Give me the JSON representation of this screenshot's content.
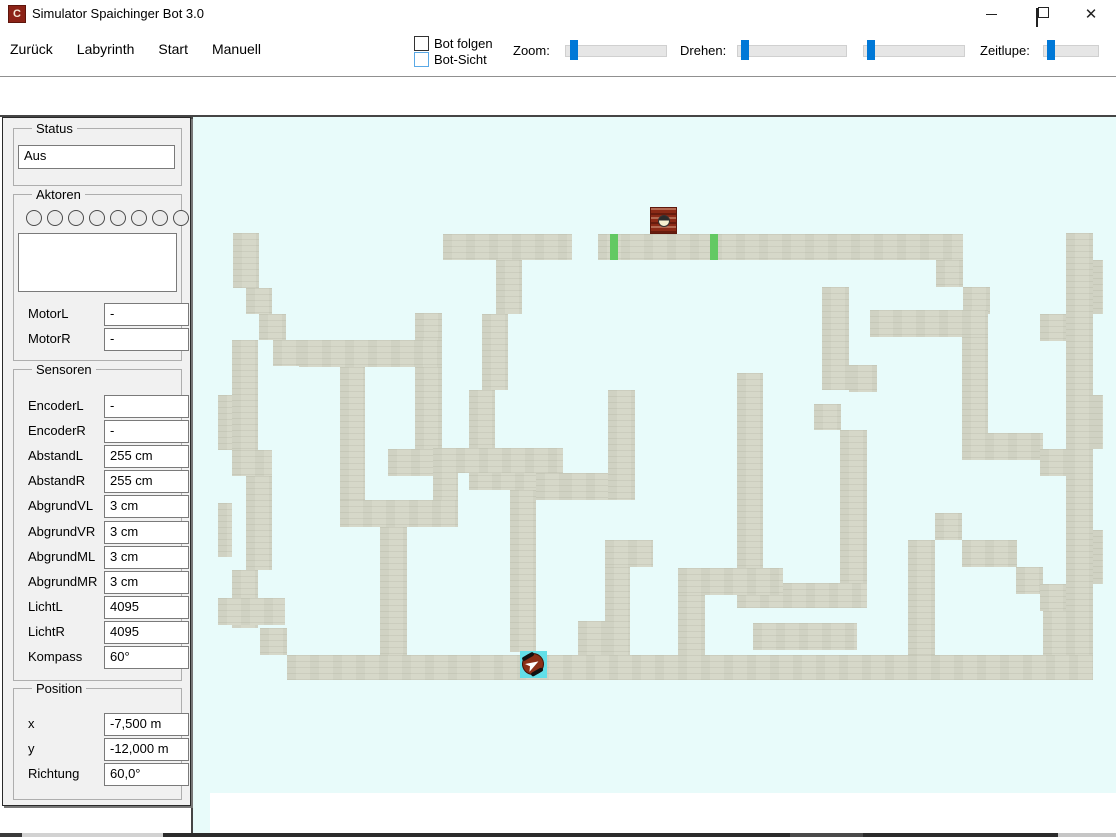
{
  "window": {
    "title": "Simulator Spaichinger Bot 3.0",
    "icon_letter": "C",
    "controls": [
      "minimize",
      "restore",
      "close"
    ]
  },
  "menu": {
    "items": [
      "Zurück",
      "Labyrinth",
      "Start",
      "Manuell"
    ]
  },
  "toolbar": {
    "checkboxes": [
      {
        "label": "Bot folgen",
        "checked": false,
        "style": "dark"
      },
      {
        "label": "Bot-Sicht",
        "checked": false,
        "style": "blue"
      }
    ],
    "sliders": [
      {
        "label": "Zoom:",
        "label_x": 513,
        "track_x": 565,
        "track_w": 100,
        "thumb_x": 4
      },
      {
        "label": "Drehen:",
        "label_x": 680,
        "track_x": 737,
        "track_w": 108,
        "thumb_x": 3
      },
      {
        "label": "",
        "label_x": 855,
        "track_x": 863,
        "track_w": 100,
        "thumb_x": 3
      },
      {
        "label": "Zeitlupe:",
        "label_x": 980,
        "track_x": 1043,
        "track_w": 54,
        "thumb_x": 3
      }
    ],
    "accent_color": "#0078d7"
  },
  "panel": {
    "status": {
      "title": "Status",
      "value": "Aus"
    },
    "aktoren": {
      "title": "Aktoren",
      "led_count": 8,
      "textbox_value": "",
      "rows": [
        {
          "label": "MotorL",
          "value": "-"
        },
        {
          "label": "MotorR",
          "value": "-"
        }
      ]
    },
    "sensoren": {
      "title": "Sensoren",
      "rows": [
        {
          "label": "EncoderL",
          "value": "-"
        },
        {
          "label": "EncoderR",
          "value": "-"
        },
        {
          "label": "AbstandL",
          "value": "255 cm"
        },
        {
          "label": "AbstandR",
          "value": "255 cm"
        },
        {
          "label": "AbgrundVL",
          "value": "3 cm"
        },
        {
          "label": "AbgrundVR",
          "value": "3 cm"
        },
        {
          "label": "AbgrundML",
          "value": "3 cm"
        },
        {
          "label": "AbgrundMR",
          "value": "3 cm"
        },
        {
          "label": "LichtL",
          "value": "4095"
        },
        {
          "label": "LichtR",
          "value": "4095"
        },
        {
          "label": "Kompass",
          "value": "60°"
        }
      ]
    },
    "position": {
      "title": "Position",
      "rows": [
        {
          "label": "x",
          "value": "-7,500 m"
        },
        {
          "label": "y",
          "value": "-12,000 m"
        },
        {
          "label": "Richtung",
          "value": "60,0°"
        }
      ]
    }
  },
  "maze": {
    "background_color": "#e8fbfa",
    "wall_color": "#d6d8c9",
    "marker_color": "#63c963",
    "bot_square_color": "#63dfe8",
    "bot_body_color": "#8a2f17",
    "red_block": {
      "x": 650,
      "y": 207,
      "w": 27,
      "h": 27
    },
    "green_markers": [
      {
        "x": 610,
        "y": 234,
        "w": 8,
        "h": 26
      },
      {
        "x": 710,
        "y": 234,
        "w": 8,
        "h": 26
      }
    ],
    "bot": {
      "x": 520,
      "y": 651,
      "w": 27,
      "h": 27,
      "heading_deg": 60
    },
    "walls": [
      [
        233,
        233,
        26,
        55
      ],
      [
        246,
        288,
        26,
        26
      ],
      [
        259,
        314,
        27,
        26
      ],
      [
        273,
        340,
        27,
        26
      ],
      [
        299,
        340,
        143,
        27
      ],
      [
        415,
        313,
        27,
        27
      ],
      [
        415,
        367,
        27,
        82
      ],
      [
        388,
        449,
        54,
        27
      ],
      [
        232,
        340,
        26,
        110
      ],
      [
        218,
        395,
        14,
        55
      ],
      [
        232,
        450,
        40,
        26
      ],
      [
        246,
        476,
        26,
        94
      ],
      [
        218,
        503,
        14,
        54
      ],
      [
        232,
        570,
        26,
        58
      ],
      [
        260,
        628,
        27,
        27
      ],
      [
        287,
        655,
        806,
        25
      ],
      [
        443,
        234,
        129,
        26
      ],
      [
        496,
        260,
        26,
        54
      ],
      [
        482,
        314,
        26,
        76
      ],
      [
        469,
        390,
        26,
        73
      ],
      [
        469,
        463,
        76,
        27
      ],
      [
        510,
        490,
        26,
        162
      ],
      [
        380,
        527,
        27,
        128
      ],
      [
        340,
        367,
        25,
        133
      ],
      [
        340,
        500,
        118,
        27
      ],
      [
        433,
        448,
        25,
        52
      ],
      [
        433,
        448,
        130,
        25
      ],
      [
        536,
        473,
        27,
        27
      ],
      [
        563,
        473,
        72,
        27
      ],
      [
        608,
        390,
        27,
        110
      ],
      [
        605,
        540,
        48,
        27
      ],
      [
        605,
        567,
        25,
        88
      ],
      [
        578,
        621,
        27,
        34
      ],
      [
        218,
        598,
        67,
        27
      ],
      [
        598,
        234,
        365,
        26
      ],
      [
        936,
        260,
        27,
        27
      ],
      [
        963,
        287,
        27,
        27
      ],
      [
        822,
        287,
        27,
        103
      ],
      [
        849,
        365,
        28,
        27
      ],
      [
        870,
        310,
        118,
        27
      ],
      [
        962,
        337,
        26,
        96
      ],
      [
        962,
        433,
        81,
        27
      ],
      [
        737,
        373,
        26,
        235
      ],
      [
        737,
        583,
        130,
        25
      ],
      [
        840,
        430,
        27,
        153
      ],
      [
        814,
        404,
        27,
        26
      ],
      [
        678,
        568,
        105,
        27
      ],
      [
        678,
        595,
        27,
        60
      ],
      [
        753,
        623,
        104,
        27
      ],
      [
        908,
        540,
        27,
        115
      ],
      [
        935,
        513,
        27,
        27
      ],
      [
        962,
        540,
        55,
        27
      ],
      [
        1016,
        567,
        27,
        27
      ],
      [
        1043,
        593,
        27,
        62
      ],
      [
        1066,
        233,
        27,
        422
      ],
      [
        1093,
        260,
        10,
        54
      ],
      [
        1040,
        314,
        26,
        27
      ],
      [
        1093,
        395,
        10,
        54
      ],
      [
        1040,
        449,
        26,
        27
      ],
      [
        1093,
        530,
        10,
        54
      ],
      [
        1040,
        584,
        26,
        27
      ]
    ]
  },
  "bottom_strip": {
    "segments": [
      {
        "x": 0,
        "w": 22,
        "color": "#3a3a3a"
      },
      {
        "x": 22,
        "w": 141,
        "color": "#d2d2d2"
      },
      {
        "x": 163,
        "w": 627,
        "color": "#2b2b2b"
      },
      {
        "x": 790,
        "w": 73,
        "color": "#4a4a4a"
      },
      {
        "x": 863,
        "w": 195,
        "color": "#2b2b2b"
      },
      {
        "x": 1058,
        "w": 58,
        "color": "#c6c6c6"
      }
    ]
  }
}
